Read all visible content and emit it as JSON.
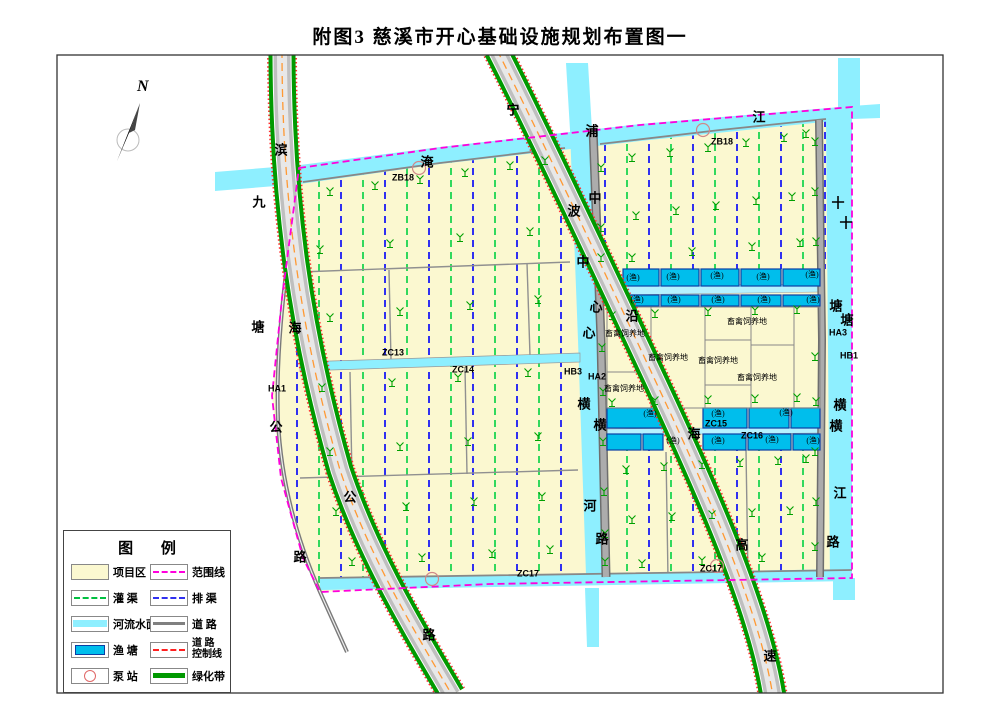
{
  "title": "附图3  慈溪市开心基础设施规划布置图一",
  "compass": {
    "label": "N"
  },
  "legend": {
    "title": "图    例",
    "col1": [
      {
        "label": "项目区"
      },
      {
        "label": "灌  渠"
      },
      {
        "label": "河流水面"
      },
      {
        "label": "渔  塘"
      },
      {
        "label": "泵  站"
      }
    ],
    "col2": [
      {
        "label": "范围线"
      },
      {
        "label": "排  渠"
      },
      {
        "label": "道  路"
      },
      {
        "label": "道  路",
        "label2": "控制线"
      },
      {
        "label": "绿化带"
      }
    ]
  },
  "colors": {
    "project_area": "#FBF8D0",
    "river": "#8EEFFF",
    "fish_pond": "#00BEEC",
    "boundary_line": "#FF00DC",
    "irrigation_channel": "#00D040",
    "drainage_channel": "#3030F0",
    "road": "#808080",
    "road_control_line": "#FF2020",
    "green_belt": "#009900"
  },
  "map": {
    "labels": [
      {
        "t": "滨"
      },
      {
        "t": "海"
      },
      {
        "t": "公"
      },
      {
        "t": "路"
      },
      {
        "t": "九"
      },
      {
        "t": "塘"
      },
      {
        "t": "公"
      },
      {
        "t": "路"
      },
      {
        "t": "淹"
      },
      {
        "t": "浦"
      },
      {
        "t": "江"
      },
      {
        "t": "宁"
      },
      {
        "t": "波"
      },
      {
        "t": "沿"
      },
      {
        "t": "海"
      },
      {
        "t": "高"
      },
      {
        "t": "速"
      },
      {
        "t": "中"
      },
      {
        "t": "心"
      },
      {
        "t": "横"
      },
      {
        "t": "河"
      },
      {
        "t": "中"
      },
      {
        "t": "心"
      },
      {
        "t": "横"
      },
      {
        "t": "路"
      },
      {
        "t": "十"
      },
      {
        "t": "塘"
      },
      {
        "t": "横"
      },
      {
        "t": "江"
      },
      {
        "t": "十"
      },
      {
        "t": "塘"
      },
      {
        "t": "横"
      },
      {
        "t": "路"
      },
      {
        "t": "ZB18"
      },
      {
        "t": "ZB18"
      },
      {
        "t": "ZC13"
      },
      {
        "t": "ZC14"
      },
      {
        "t": "ZC15"
      },
      {
        "t": "ZC16"
      },
      {
        "t": "ZC17"
      },
      {
        "t": "ZC17"
      },
      {
        "t": "HA1"
      },
      {
        "t": "HB3"
      },
      {
        "t": "HA2"
      },
      {
        "t": "HA3"
      },
      {
        "t": "HB1"
      },
      {
        "t": "(渔)"
      },
      {
        "t": "(渔)"
      },
      {
        "t": "(渔)"
      },
      {
        "t": "(渔)"
      },
      {
        "t": "(渔)"
      },
      {
        "t": "(渔)"
      },
      {
        "t": "(渔)"
      },
      {
        "t": "(渔)"
      },
      {
        "t": "(渔)"
      },
      {
        "t": "(渔)"
      },
      {
        "t": "(渔)"
      },
      {
        "t": "(渔)"
      },
      {
        "t": "(渔)"
      },
      {
        "t": "(渔)"
      },
      {
        "t": "(渔)"
      },
      {
        "t": "(渔)"
      },
      {
        "t": "(渔)"
      },
      {
        "t": "畜禽饲养地"
      },
      {
        "t": "畜禽饲养地"
      },
      {
        "t": "畜禽饲养地"
      },
      {
        "t": "畜禽饲养地"
      },
      {
        "t": "畜禽饲养地"
      },
      {
        "t": "畜禽饲养地"
      }
    ]
  }
}
